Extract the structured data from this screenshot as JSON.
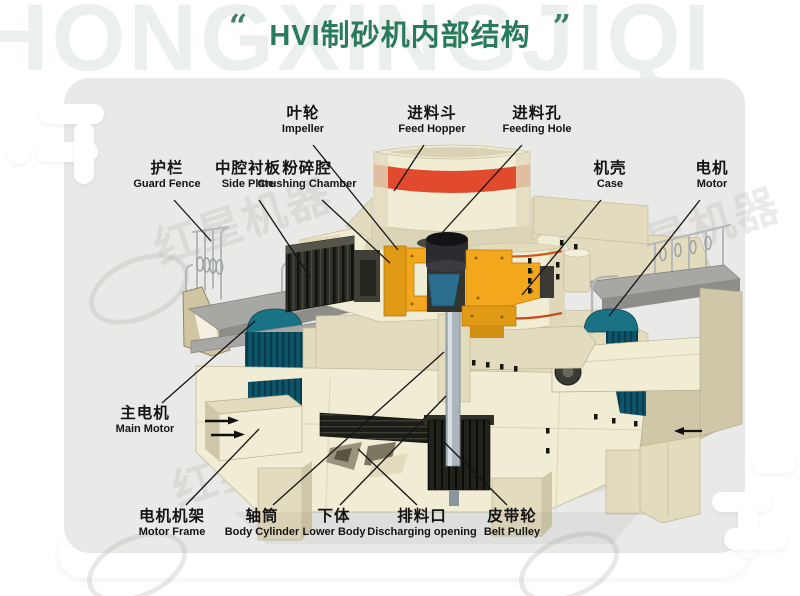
{
  "colors": {
    "green": "#2a7a5c",
    "quote": "#3f8168",
    "panel": "#e9e9e7",
    "wm": "#ecf0ec",
    "ink": "#141414",
    "c1": "#f1ecd4",
    "c2": "#e2dbbd",
    "c3": "#cfc7a8",
    "tan": "#cfc5a2",
    "red": "#e14a2c",
    "stripe": "#d05a1a",
    "yellow": "#f2a71d",
    "yellow2": "#e09a15",
    "teal": "#1a7285",
    "teal2": "#0e556a",
    "tealline": "#083d4f",
    "steel": "#a7a7a3",
    "steel2": "#8d8d89",
    "rail": "#b5b8b9",
    "shaft": "#abb5bd"
  },
  "header": {
    "watermark_text": "HONGXINGJIQI",
    "open_quote": "“",
    "close_quote": "”",
    "title": "HVI制砂机内部结构"
  },
  "watermark": {
    "stamp_text": "红星机器"
  },
  "diagram": {
    "labels": [
      {
        "id": "impeller",
        "cn": "叶轮",
        "en": "Impeller",
        "x": 303,
        "y": 105,
        "line": [
          313,
          145,
          398,
          250
        ]
      },
      {
        "id": "feed-hopper",
        "cn": "进料斗",
        "en": "Feed Hopper",
        "x": 432,
        "y": 105,
        "line": [
          424,
          145,
          394,
          191
        ]
      },
      {
        "id": "feeding-hole",
        "cn": "进料孔",
        "en": "Feeding Hole",
        "x": 537,
        "y": 105,
        "line": [
          522,
          145,
          431,
          245
        ]
      },
      {
        "id": "guard-fence",
        "cn": "护栏",
        "en": "Guard Fence",
        "x": 167,
        "y": 160,
        "line": [
          174,
          200,
          211,
          241
        ]
      },
      {
        "id": "side-plate",
        "cn": "中腔衬板",
        "en": "Side Plate",
        "x": 248,
        "y": 160,
        "line": [
          259,
          200,
          310,
          277
        ]
      },
      {
        "id": "crushing-chamber",
        "cn": "粉碎腔",
        "en": "Crushing Chamber",
        "x": 307,
        "y": 160,
        "line": [
          322,
          200,
          390,
          263
        ]
      },
      {
        "id": "case",
        "cn": "机壳",
        "en": "Case",
        "x": 610,
        "y": 160,
        "line": [
          601,
          200,
          522,
          295
        ]
      },
      {
        "id": "motor",
        "cn": "电机",
        "en": "Motor",
        "x": 712,
        "y": 160,
        "line": [
          700,
          200,
          609,
          316
        ]
      },
      {
        "id": "main-motor",
        "cn": "主电机",
        "en": "Main Motor",
        "x": 145,
        "y": 405,
        "line": [
          162,
          403,
          255,
          321
        ]
      },
      {
        "id": "motor-frame",
        "cn": "电机机架",
        "en": "Motor Frame",
        "x": 172,
        "y": 508,
        "line": [
          186,
          505,
          259,
          429
        ]
      },
      {
        "id": "body-cylinder",
        "cn": "轴筒",
        "en": "Body Cylinder",
        "x": 262,
        "y": 508,
        "line": [
          273,
          505,
          444,
          352
        ]
      },
      {
        "id": "lower-body",
        "cn": "下体",
        "en": "Lower Body",
        "x": 334,
        "y": 508,
        "line": [
          340,
          505,
          446,
          396
        ]
      },
      {
        "id": "discharging-opening",
        "cn": "排料口",
        "en": "Discharging opening",
        "x": 422,
        "y": 508,
        "line": [
          417,
          505,
          358,
          449
        ]
      },
      {
        "id": "belt-pulley",
        "cn": "皮带轮",
        "en": "Belt Pulley",
        "x": 512,
        "y": 508,
        "line": [
          507,
          505,
          444,
          442
        ]
      }
    ]
  }
}
